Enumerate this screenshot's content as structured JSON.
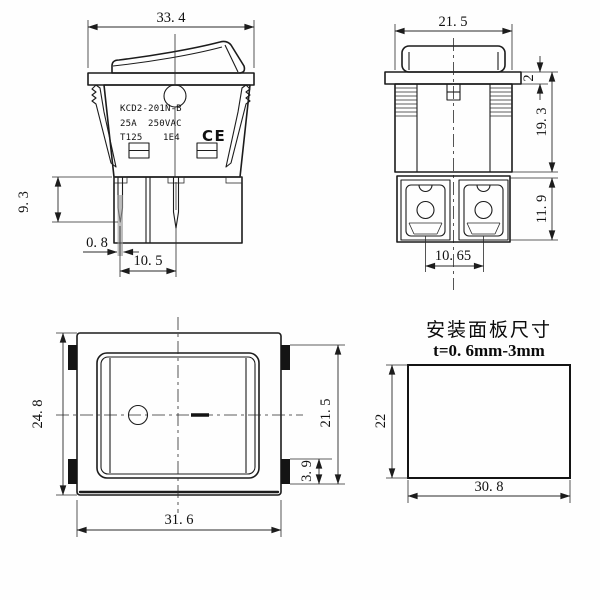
{
  "drawing": {
    "type": "rocker-switch-technical-drawing",
    "line_color": "#1c1c1c",
    "highlight_pin_color": "#9a9a9a"
  },
  "views": {
    "side": {
      "dims": {
        "width": "33. 4",
        "pin_length": "9. 3",
        "pin_width": "0. 8",
        "pin_pitch": "10. 5"
      },
      "markings": {
        "model": "KCD2-201N-B",
        "current": "25A",
        "voltage": "250VAC",
        "temp": "T125",
        "code": "1E4",
        "ce": "CE"
      }
    },
    "front": {
      "dims": {
        "width": "21. 5",
        "flange_thickness": "2",
        "body_height": "19. 3",
        "terminal_height": "11. 9",
        "terminal_pitch": "10. 65"
      }
    },
    "top": {
      "dims": {
        "height": "24. 8",
        "width": "31. 6",
        "tab_span": "21. 5",
        "tab_height": "3. 9"
      }
    },
    "panel": {
      "title": "安装面板尺寸",
      "thickness": "t=0. 6mm-3mm",
      "dims": {
        "height": "22",
        "width": "30. 8"
      }
    }
  }
}
